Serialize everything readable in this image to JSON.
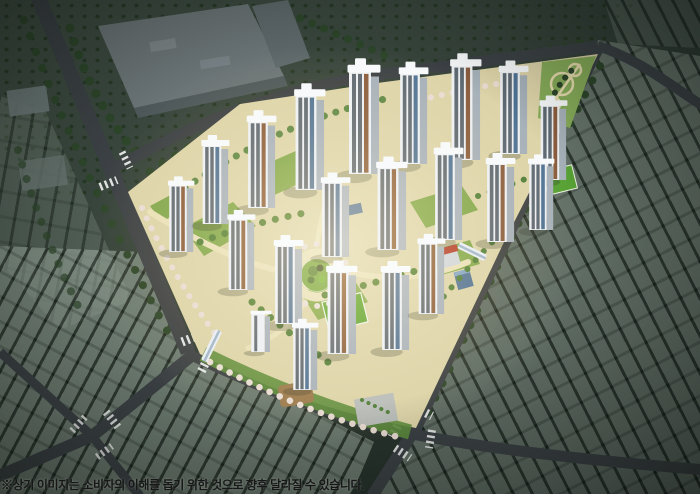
{
  "disclaimer": {
    "text": "※상기 이미지는 소비자의 이해를 돕기 위한 것으로 향후 달라질 수 있습니다."
  },
  "scene": {
    "type": "apartment-complex-aerial-rendering",
    "tower_count": 21,
    "landmarks": [
      "central-circular-park",
      "apartment-towers",
      "neighborhood-park",
      "sports-field",
      "playground",
      "plaza",
      "pedestrian-overpass",
      "crosswalks",
      "perimeter-roads",
      "factory-block",
      "low-rise-neighborhood"
    ]
  },
  "palette": {
    "night_base": "#2e3a33",
    "outskirt_block": "#93a196",
    "factory_roof": "#6b7476",
    "factory_side": "#4e585a",
    "road": "#3b4044",
    "crosswalk": "#f2f4f2",
    "complex_ground": "#ddd3a8",
    "path": "#e9dfb6",
    "lawn": "#7ba449",
    "field": "#57a134",
    "tree_dark": "#2c4529",
    "tree_green": "#4e7d3a",
    "blossom": "#e9dcd2",
    "tower_face": "#edeff1",
    "tower_side": "#a6b0b8",
    "tower_window": "#5d6872",
    "tower_accent": "#8a5c3e",
    "tower_glass": "#4f7293",
    "roof": "#f7f9fa",
    "red_roof": "#b23a2e",
    "glow": "#ffd98c"
  }
}
